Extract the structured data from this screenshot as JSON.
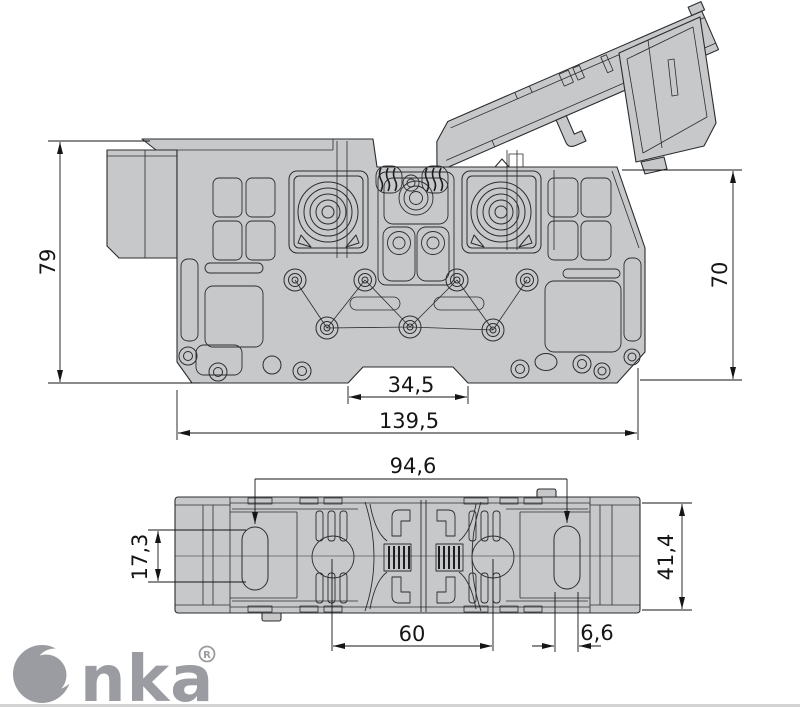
{
  "dims": {
    "d79": "79",
    "d70": "70",
    "d345": "34,5",
    "d1395": "139,5",
    "d946": "94,6",
    "d173": "17,3",
    "d414": "41,4",
    "d60": "60",
    "d66": "6,6"
  },
  "logo": {
    "tail": "nka",
    "registered": "R"
  },
  "colors": {
    "part_fill": "#c7c8ca",
    "logo": "#9b9ca1"
  }
}
